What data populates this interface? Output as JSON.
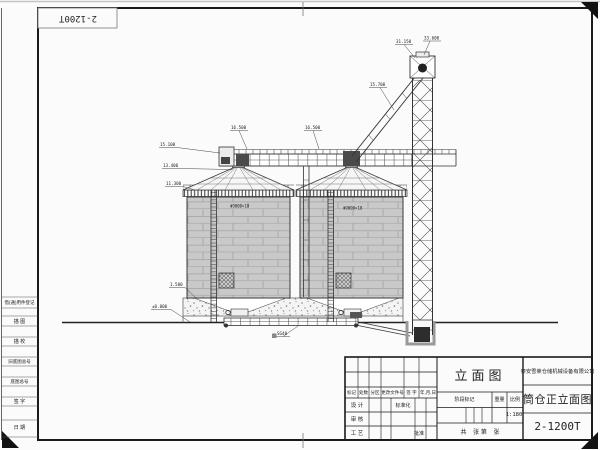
{
  "frame": {
    "code_box": "2-1200T"
  },
  "margin": {
    "items": [
      "借(通)用件登记",
      "描 图",
      "描 校",
      "旧底图总号",
      "底图总号",
      "签 字",
      "日 期"
    ]
  },
  "title_block": {
    "company": "泰安雪莱仓储机械设备有限公司",
    "view_label": "立面图",
    "drawing_title": "筒仓正立面图",
    "drawing_code": "2-1200T",
    "stage_label": "阶段标记",
    "weight_label": "重量",
    "scale_label": "比例",
    "scale_value": "1:180",
    "sheet_text": "共    张 第    张",
    "revision_headers": [
      "标记",
      "处数",
      "分区",
      "更改文件号",
      "签 字",
      "年,月,日"
    ],
    "roles": {
      "design": "设 计",
      "standard": "标准化",
      "check": "审 核",
      "process": "工 艺",
      "approve": "批准"
    }
  },
  "drawing": {
    "silo_label": "Φ9000×10",
    "colors": {
      "line": "#333333",
      "wall_fill": "#c9c9c9",
      "paper": "#fbfbfb"
    }
  },
  "annotations": {
    "marks": [
      "33.600",
      "31.150",
      "15.700",
      "16.500",
      "16.500",
      "15.100",
      "13.400",
      "11.300",
      "1.500",
      "±0.000",
      "SG40"
    ]
  }
}
